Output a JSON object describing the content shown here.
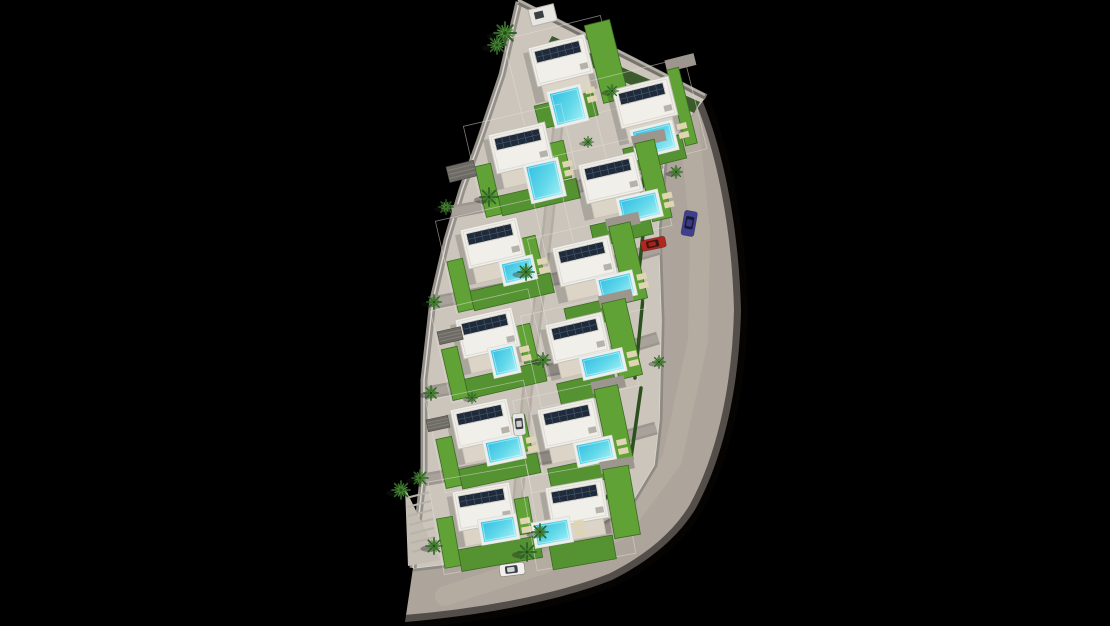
{
  "scene": {
    "name": "aerial-render-villa-development-site-plan",
    "width": 1110,
    "height": 626
  },
  "palette": {
    "bg": "#000000",
    "land": "#cbc5bc",
    "road": "#ada49b",
    "road_wear": "#bcb3a9",
    "road_edge_shadow": "#0a0806",
    "sidewalk": "#8e8a84",
    "curb": "#dcd8d1",
    "left_walk": "#95908a",
    "street": "#9c968e",
    "street_center": "#a8a29a",
    "alley": "#b3ada4",
    "alley_center": "#bfb9b0",
    "wall": "#77736d",
    "wall_hi": "#b3aea6",
    "lawn": "#60a236",
    "lawn_alt": "#549232",
    "lawn_edge": "#3c6b22",
    "hedge": "#2b4f1d",
    "roof": "#f0efea",
    "roof_edge": "#c9c5bd",
    "parapet": "#dedbd3",
    "terrace": "#dbd4c7",
    "terrace_edge": "#c6c0b5",
    "solar": "#1f2b3a",
    "solar_grid": "#44556c",
    "solar_frame": "#d6d2ca",
    "deck": "#eceeec",
    "pool_deep": "#33bfe2",
    "pool_mid": "#62d8ea",
    "pool_light": "#a5eef5",
    "mat": "#dfd5b2",
    "house_shadow": "rgba(0,0,0,0.16)",
    "palm": "#2e6326",
    "palm_light": "#4e8c33",
    "palm_core": "#234d1b",
    "tree_shadow": "rgba(25,25,25,0.35)",
    "pergola": "#6e6b65",
    "stair": "#b9b3aa",
    "stair_base": "#c3bdb4",
    "fence": "rgba(230,226,219,0.55)",
    "shed": "#e8e6e0",
    "shed_win": "#3a3f45",
    "ac": "#b6b2ab"
  },
  "land": {
    "outline": "519,2 706,97 665,150 658,230 661,320 659,420 654,465 630,505 585,532 520,552 455,563 413,568 424,470 424,380 433,300 447,240 462,190 480,140 502,75",
    "left_walk": "519,2 502,75 480,140 462,190 447,240 433,300 424,380 424,470 413,568",
    "top_wall": [
      519,
      2,
      706,
      97
    ],
    "stair_base": "405,488 440,560 408,566"
  },
  "roads": {
    "surface": "M700,95 C724,150 739,230 741,310 C739,395 721,462 696,508 C678,538 648,562 612,580 C556,602 478,616 405,622 L413,568 C455,563 520,552 585,532 C620,519 645,498 654,465 C660,440 661,380 661,320 C661,260 658,185 665,150 Z",
    "outer_edge": "M700,95 C724,150 739,230 741,310 C739,395 721,462 696,508 C678,538 648,562 612,580 C556,602 478,616 405,622",
    "wear_band": "688,115 700,230 698,340 672,460 620,530 540,565 445,596",
    "inner_sidewalk": "700,98 665,150 658,230 661,320 659,420 654,465 630,505 585,532 520,552 455,563 413,568"
  },
  "streets": [
    {
      "pts": "452,212 560,192 662,162",
      "w": 13
    },
    {
      "pts": "432,303 560,278 660,248",
      "w": 13
    },
    {
      "pts": "426,393 560,368 658,338",
      "w": 13
    },
    {
      "pts": "423,480 560,455 656,428",
      "w": 13
    }
  ],
  "alley": {
    "pts": "565,55 548,225 527,395 513,555",
    "w": 11
  },
  "hedges": {
    "lines": [
      "650,118 641,198",
      "646,208 637,288",
      "643,298 635,378",
      "641,388 631,458",
      "627,470 600,506"
    ],
    "top_polygon": "552,36 700,102 694,113 546,47"
  },
  "villa_template": {
    "w": 58,
    "h": 40,
    "terrace": [
      4,
      40,
      48,
      16
    ],
    "solar": [
      5,
      5,
      46,
      12
    ],
    "ac": [
      46,
      28,
      8,
      6
    ],
    "fence": [
      -22,
      -14,
      100,
      94
    ],
    "shadow": [
      -6,
      4,
      64,
      52
    ]
  },
  "villas": [
    {
      "id": "villa-1",
      "x": 528,
      "y": 48,
      "rot": -14,
      "pool": [
        10,
        50,
        29,
        32
      ],
      "lawns": [
        [
          60,
          -8,
          26,
          80
        ],
        [
          -8,
          58,
          60,
          24
        ]
      ]
    },
    {
      "id": "villa-2",
      "x": 612,
      "y": 90,
      "rot": -14,
      "pool": [
        10,
        46,
        38,
        25
      ],
      "lawns": [
        [
          58,
          -6,
          12,
          78
        ],
        [
          -4,
          60,
          60,
          24
        ]
      ],
      "drive": [
        58,
        -16,
        30,
        12
      ]
    },
    {
      "id": "villa-3",
      "x": 488,
      "y": 135,
      "rot": -13,
      "pool": [
        30,
        40,
        30,
        34
      ],
      "lawns": [
        [
          -20,
          28,
          16,
          52
        ],
        [
          -4,
          62,
          80,
          20
        ],
        [
          58,
          22,
          14,
          38
        ]
      ]
    },
    {
      "id": "villa-4",
      "x": 578,
      "y": 165,
      "rot": -13,
      "pool": [
        32,
        44,
        37,
        22
      ],
      "lawns": [
        [
          60,
          -8,
          20,
          80
        ],
        [
          -2,
          62,
          60,
          22
        ]
      ],
      "drive": [
        58,
        -16,
        34,
        12
      ]
    },
    {
      "id": "villa-5",
      "x": 460,
      "y": 230,
      "rot": -13,
      "pool": [
        33,
        43,
        29,
        19
      ],
      "lawns": [
        [
          -20,
          28,
          16,
          52
        ],
        [
          -4,
          62,
          82,
          20
        ],
        [
          58,
          22,
          14,
          38
        ]
      ]
    },
    {
      "id": "villa-6",
      "x": 552,
      "y": 248,
      "rot": -13,
      "pool": [
        38,
        42,
        32,
        20
      ],
      "lawns": [
        [
          60,
          -8,
          22,
          78
        ],
        [
          -2,
          62,
          58,
          22
        ]
      ],
      "drive": [
        58,
        -16,
        34,
        12
      ]
    },
    {
      "id": "villa-7",
      "x": 455,
      "y": 320,
      "rot": -13,
      "pool": [
        28,
        38,
        22,
        25
      ],
      "lawns": [
        [
          -20,
          26,
          16,
          52
        ],
        [
          -4,
          60,
          80,
          20
        ],
        [
          58,
          20,
          14,
          38
        ]
      ]
    },
    {
      "id": "villa-8",
      "x": 545,
      "y": 325,
      "rot": -13,
      "pool": [
        28,
        42,
        39,
        18
      ],
      "lawns": [
        [
          60,
          -8,
          24,
          78
        ],
        [
          -2,
          60,
          58,
          22
        ]
      ],
      "drive": [
        58,
        -16,
        34,
        12
      ]
    },
    {
      "id": "villa-9",
      "x": 450,
      "y": 410,
      "rot": -12,
      "pool": [
        28,
        40,
        34,
        20
      ],
      "lawns": [
        [
          -20,
          26,
          16,
          50
        ],
        [
          -4,
          60,
          80,
          20
        ],
        [
          58,
          20,
          14,
          36
        ]
      ]
    },
    {
      "id": "villa-10",
      "x": 537,
      "y": 410,
      "rot": -12,
      "pool": [
        31,
        43,
        34,
        19
      ],
      "lawns": [
        [
          60,
          -8,
          24,
          76
        ],
        [
          -2,
          60,
          56,
          22
        ]
      ],
      "drive": [
        58,
        -16,
        34,
        12
      ]
    },
    {
      "id": "villa-11",
      "x": 452,
      "y": 492,
      "rot": -10,
      "pool": [
        23,
        35,
        33,
        20
      ],
      "lawns": [
        [
          -20,
          24,
          16,
          50
        ],
        [
          -4,
          58,
          82,
          22
        ],
        [
          60,
          18,
          14,
          36
        ]
      ]
    },
    {
      "id": "villa-12",
      "x": 545,
      "y": 488,
      "rot": -10,
      "pool": [
        -17,
        35,
        33,
        20
      ],
      "lawns": [
        [
          60,
          -8,
          26,
          70
        ],
        [
          -6,
          58,
          64,
          24
        ]
      ],
      "drive": [
        58,
        -16,
        34,
        12
      ]
    }
  ],
  "trees": [
    [
      505,
      33,
      1.2
    ],
    [
      497,
      45,
      1.0
    ],
    [
      489,
      197,
      1.0
    ],
    [
      446,
      207,
      0.8
    ],
    [
      526,
      272,
      0.9
    ],
    [
      434,
      302,
      0.8
    ],
    [
      543,
      360,
      0.8
    ],
    [
      431,
      393,
      0.8
    ],
    [
      420,
      478,
      0.9
    ],
    [
      401,
      490,
      1.0
    ],
    [
      434,
      546,
      0.9
    ],
    [
      527,
      552,
      1.0
    ],
    [
      676,
      172,
      0.7
    ],
    [
      659,
      362,
      0.7
    ],
    [
      612,
      91,
      0.7
    ],
    [
      588,
      142,
      0.6
    ],
    [
      472,
      398,
      0.6
    ],
    [
      540,
      532,
      0.9
    ]
  ],
  "cars": [
    {
      "name": "car-red",
      "x": 640,
      "y": 241,
      "w": 25,
      "h": 11,
      "rot": -12,
      "body": "#b0271f",
      "glass": "#3a1512"
    },
    {
      "name": "car-blue",
      "x": 685,
      "y": 210,
      "w": 13,
      "h": 25,
      "rot": 10,
      "body": "#3f3f92",
      "glass": "#15182e"
    },
    {
      "name": "car-white-alley",
      "x": 512,
      "y": 414,
      "w": 12,
      "h": 22,
      "rot": -6,
      "body": "#e8e6e2",
      "glass": "#3a3f48"
    },
    {
      "name": "car-white-road",
      "x": 499,
      "y": 565,
      "w": 25,
      "h": 12,
      "rot": -7,
      "body": "#f1f0ec",
      "glass": "#3a3f48"
    }
  ],
  "pergolas": [
    [
      446,
      167,
      28,
      16,
      -14
    ],
    [
      437,
      332,
      24,
      13,
      -13
    ],
    [
      426,
      420,
      22,
      12,
      -12
    ]
  ],
  "stairs": [
    [
      406,
      498,
      430,
      492
    ],
    [
      407,
      507,
      431,
      501
    ],
    [
      408,
      516,
      432,
      510
    ],
    [
      409,
      525,
      433,
      519
    ],
    [
      410,
      534,
      434,
      528
    ],
    [
      411,
      543,
      435,
      537
    ],
    [
      412,
      552,
      436,
      546
    ]
  ],
  "shed": {
    "x": 528,
    "y": 10,
    "w": 26,
    "h": 17,
    "rot": -14
  }
}
